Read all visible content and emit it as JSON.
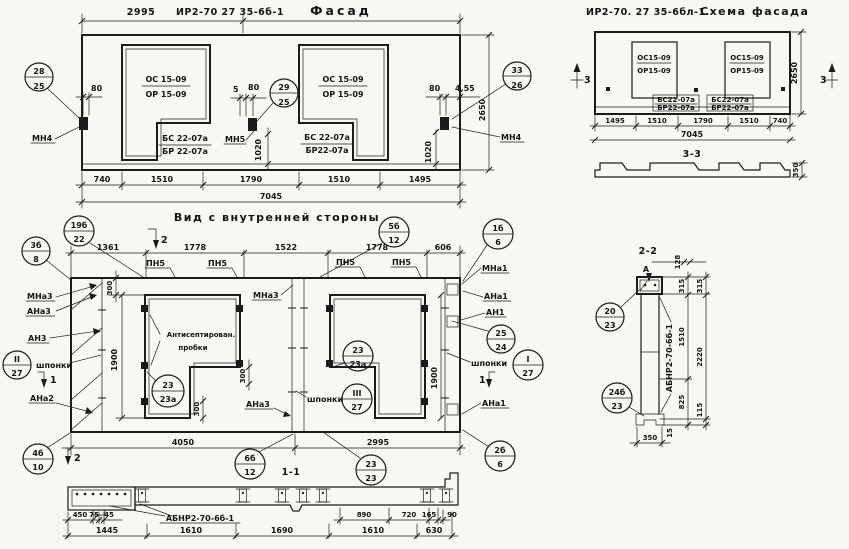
{
  "facade": {
    "dim_2995": "2995",
    "code": "ИР2-70 27 35-6б-1",
    "title": "Фасад",
    "window_top": "ОС 15-09",
    "window_bottom": "ОР 15-09",
    "sill_top": "БС 22-07а",
    "sill_bottom": "БР 22-07а",
    "sill2_bottom": "БР22-07а",
    "callout_28_25": {
      "top": "28",
      "bottom": "25"
    },
    "callout_29_25": {
      "top": "29",
      "bottom": "25"
    },
    "callout_33_26": {
      "top": "33",
      "bottom": "26"
    },
    "label_mn4": "МН4",
    "label_mn5": "МН5",
    "dim_80": "80",
    "dim_5": "5",
    "dim_455": "4,55",
    "dim_1020": "1020",
    "dim_2650": "2650",
    "bottom_dims": [
      "740",
      "1510",
      "1790",
      "1510",
      "1495"
    ],
    "total": "7045"
  },
  "schema": {
    "code": "ИР2-70. 27 35-6бл-1.",
    "title": "Схема фасада",
    "window_top": "ОС15-09",
    "window_bottom": "ОР15-09",
    "sill_top": "БС22-07а",
    "sill_bottom": "БР22-07а",
    "section_mark": "3",
    "dim_2650": "2650",
    "bottom_dims": [
      "1495",
      "1510",
      "1790",
      "1510",
      "740"
    ],
    "total": "7045",
    "section_title": "3-3",
    "dim_350": "350"
  },
  "inner": {
    "title": "Вид с внутренней стороны",
    "top_dims": [
      "1361",
      "1778",
      "1522",
      "1778",
      "606"
    ],
    "label_pn5": "ПН5",
    "sec1": "1",
    "sec2": "2",
    "callouts": {
      "c3b8": {
        "top": "3б",
        "bottom": "8"
      },
      "c19b22": {
        "top": "19б",
        "bottom": "22"
      },
      "c5b12": {
        "top": "5б",
        "bottom": "12"
      },
      "c1b6": {
        "top": "1б",
        "bottom": "6"
      },
      "c2b6": {
        "top": "2б",
        "bottom": "6"
      },
      "c4b10": {
        "top": "4б",
        "bottom": "10"
      },
      "c6b12": {
        "top": "6б",
        "bottom": "12"
      },
      "c23_23a": {
        "top": "23",
        "bottom": "23а"
      },
      "c23_23": {
        "top": "23",
        "bottom": "23"
      },
      "c25_24": {
        "top": "25",
        "bottom": "24"
      },
      "cI27": {
        "top": "I",
        "bottom": "27"
      },
      "cII27": {
        "top": "II",
        "bottom": "27"
      },
      "cIII27": {
        "top": "III",
        "bottom": "27"
      }
    },
    "labels": {
      "mna3": "МНа3",
      "ana3": "АНа3",
      "an3": "АН3",
      "ana2": "АНа2",
      "mna1": "МНа1",
      "ana1": "АНа1",
      "an1": "АН1",
      "shponki": "шпонки",
      "anti1": "Антисептирован.",
      "anti2": "пробки"
    },
    "dim_300": "300",
    "dim_1900": "1900",
    "bottom_dims": [
      "4050",
      "2995"
    ],
    "section_title": "1-1"
  },
  "s11": {
    "label": "АБНР2-70-6б-1",
    "row1_left": [
      "450",
      "75",
      "45"
    ],
    "row1_right": [
      "890",
      "720",
      "165",
      "90"
    ],
    "row2": [
      "1445",
      "1610",
      "1690",
      "1610",
      "630"
    ]
  },
  "s22": {
    "title": "2-2",
    "marker": "А",
    "label": "АБНР2-70-6б-1",
    "dims": {
      "d128": "128",
      "d315": "315",
      "d1510": "1510",
      "d2220": "2220",
      "d825": "825",
      "d115": "115",
      "d350": "350",
      "d15": "15"
    },
    "callout_20_23": {
      "top": "20",
      "bottom": "23"
    },
    "callout_24b_23": {
      "top": "24б",
      "bottom": "23"
    }
  }
}
